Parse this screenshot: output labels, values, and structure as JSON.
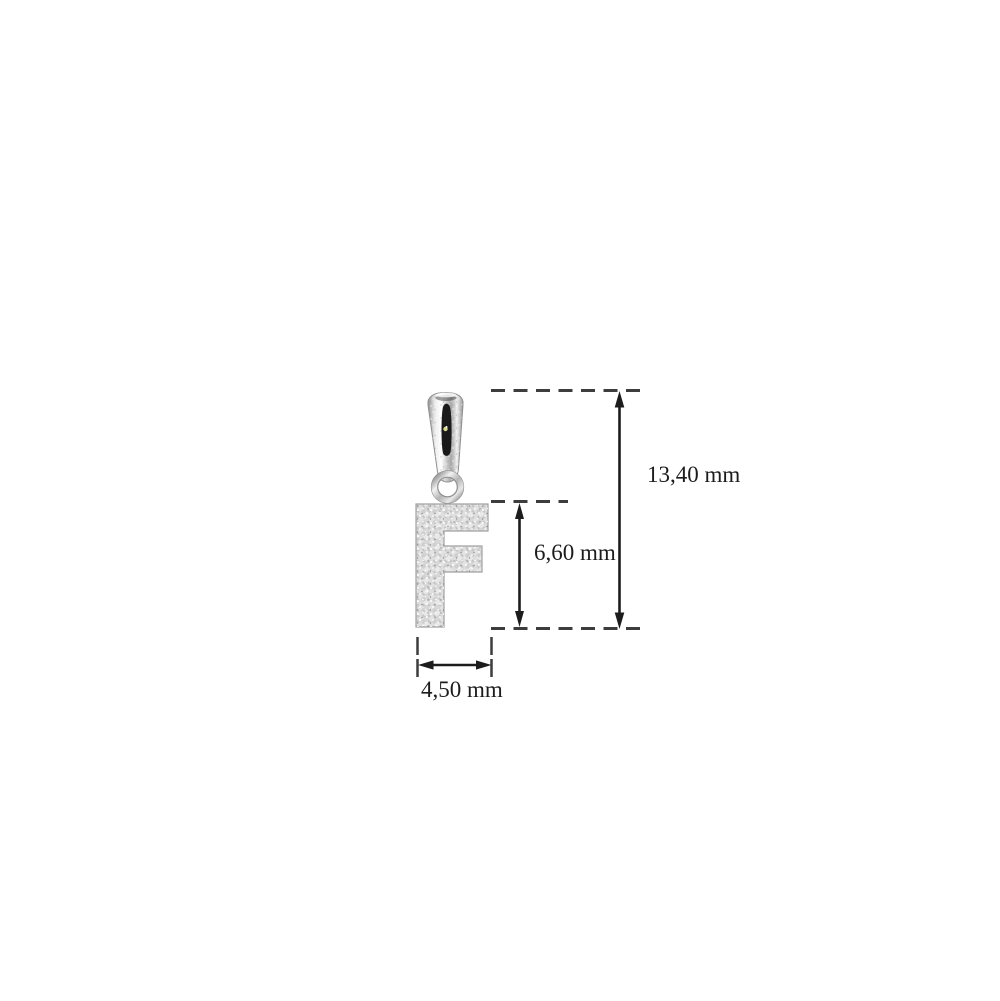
{
  "diagram": {
    "kind": "jewelry pendant dimension diagram",
    "pendant_letter": "F"
  },
  "dimensions": {
    "total_height": {
      "label": "13,40 mm"
    },
    "letter_height": {
      "label": "6,60 mm"
    },
    "width": {
      "label": "4,50 mm"
    }
  },
  "colors": {
    "background": "#ffffff",
    "dimension_dash": "#3d3d3d",
    "dimension_arrow": "#1c1c1c",
    "label_text": "#1c1c1c",
    "pave_base": "#c4c4c4",
    "bail_slot": "#1a1a1a",
    "bail_sparkle": "#d9d98f"
  }
}
